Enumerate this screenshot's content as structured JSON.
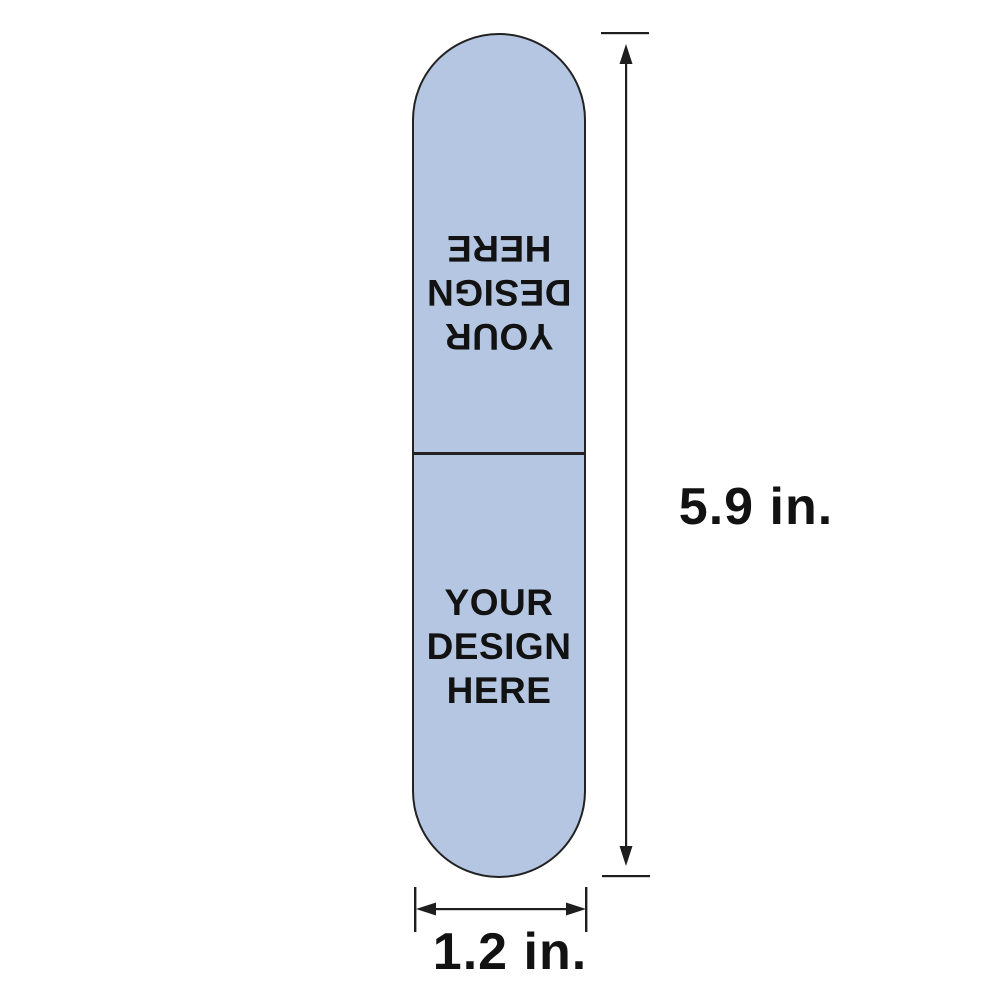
{
  "template": {
    "shape": "vertical-capsule",
    "fill_color": "#b4c6e2",
    "outline_color": "#222222",
    "text_color": "#121212",
    "top_panel": {
      "orientation": "rotated-180",
      "lines": [
        "YOUR",
        "DESIGN",
        "HERE"
      ]
    },
    "bottom_panel": {
      "orientation": "upright",
      "lines": [
        "YOUR",
        "DESIGN",
        "HERE"
      ]
    }
  },
  "dimensions": {
    "height": {
      "label": "5.9 in."
    },
    "width": {
      "label": "1.2 in."
    },
    "arrow_color": "#1e1e1e"
  }
}
